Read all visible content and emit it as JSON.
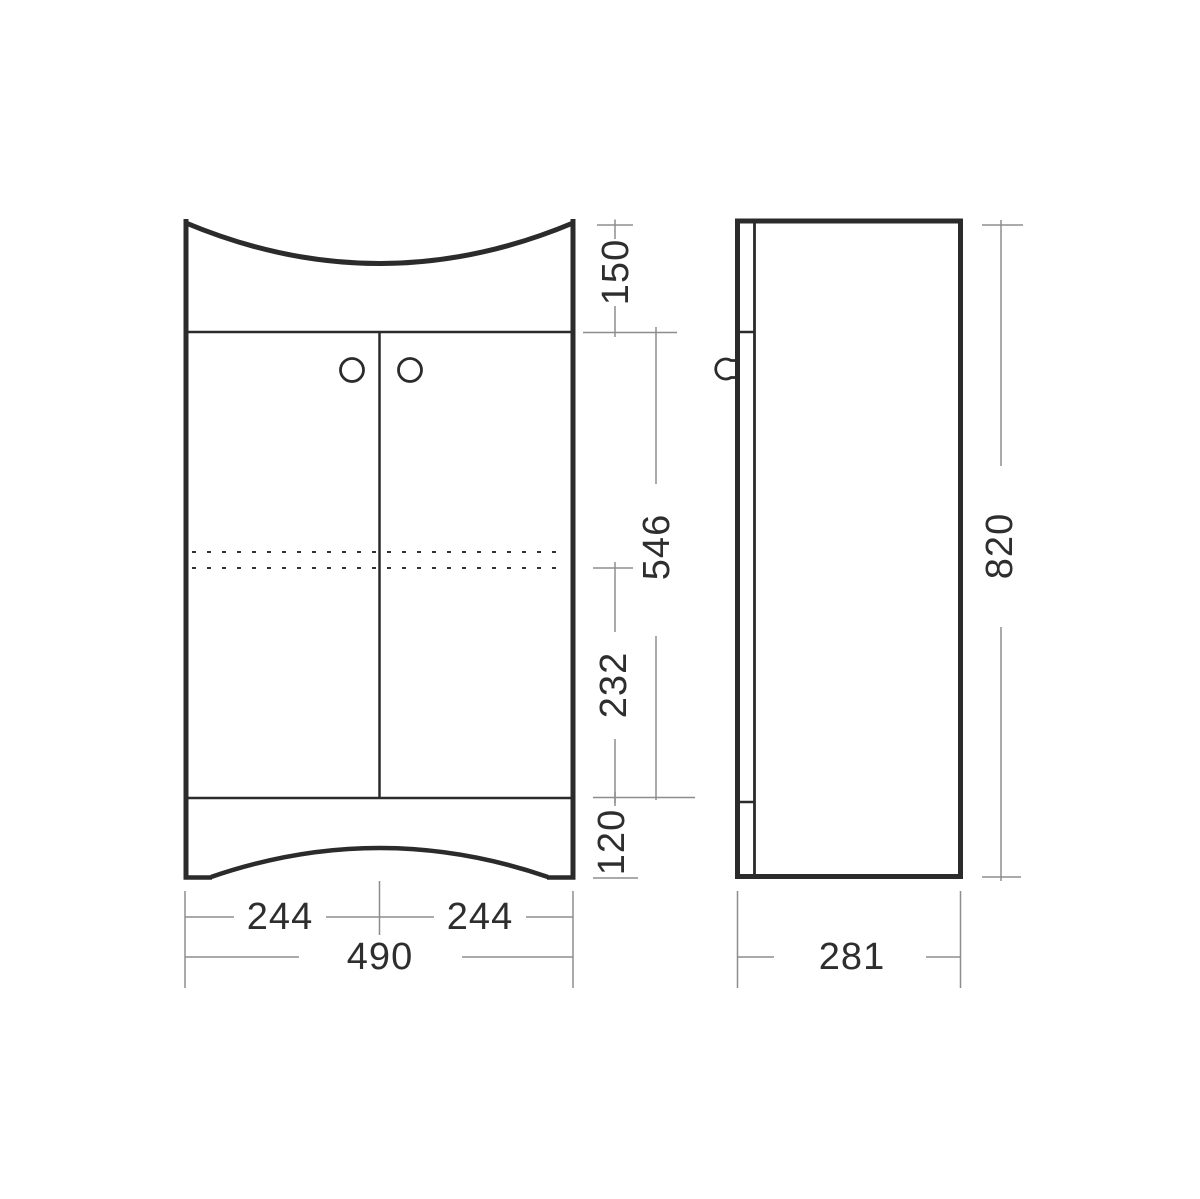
{
  "front": {
    "dims": {
      "top_section": "150",
      "doors_height": "546",
      "shelf_to_plinth": "232",
      "plinth": "120",
      "door_left_width": "244",
      "door_right_width": "244",
      "overall_width": "490"
    }
  },
  "side": {
    "dims": {
      "overall_height": "820",
      "overall_depth": "281"
    }
  },
  "colors": {
    "outline": "#2b2b2b",
    "dimension_lines": "#8d8d8d",
    "text": "#2e2e2e",
    "background": "#ffffff"
  }
}
